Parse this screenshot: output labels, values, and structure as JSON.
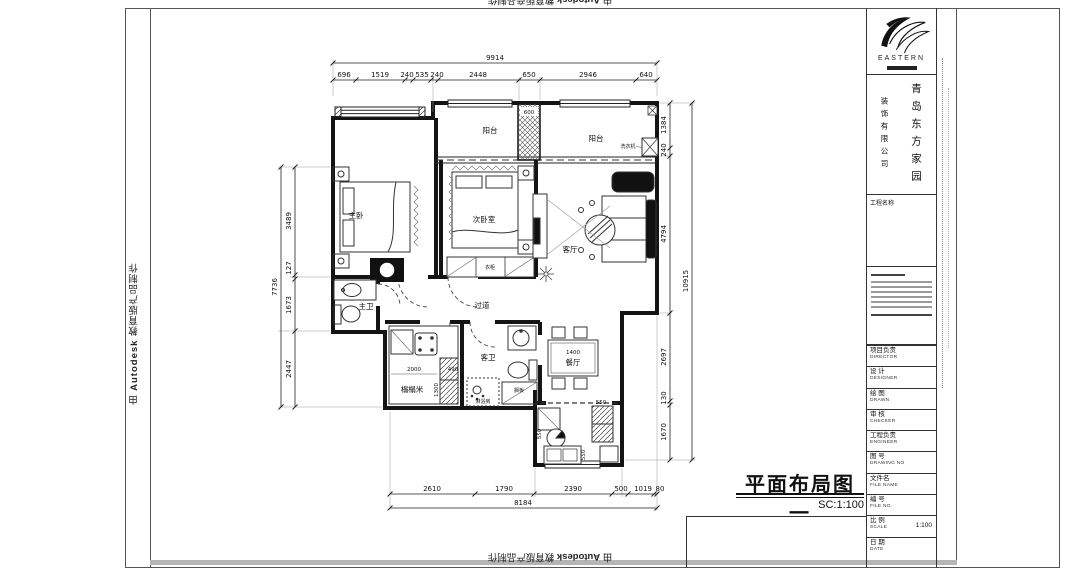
{
  "edge_stamp": {
    "prefix": "由 ",
    "brand": "Autodesk",
    "suffix": " 教育版产品制作"
  },
  "sheet": {
    "title": "平面布局图一",
    "scale_note": "SC:1:100"
  },
  "title_block": {
    "logo_text": "EASTERN",
    "company_name": "青岛东方家园",
    "company_sub": "装饰有限公司",
    "project_name_label": "工程名称",
    "fields": [
      {
        "cn": "项目负责",
        "en": "DIRECTOR",
        "value": ""
      },
      {
        "cn": "设 计",
        "en": "DESIGNER",
        "value": ""
      },
      {
        "cn": "绘 图",
        "en": "DRAWN",
        "value": ""
      },
      {
        "cn": "审 核",
        "en": "CHECKER",
        "value": ""
      },
      {
        "cn": "工程负责",
        "en": "ENGINEER",
        "value": ""
      },
      {
        "cn": "图 号",
        "en": "DRAWING NO",
        "value": ""
      },
      {
        "cn": "文件名",
        "en": "FILE NAME",
        "value": ""
      },
      {
        "cn": "编 号",
        "en": "FILE NO.",
        "value": ""
      },
      {
        "cn": "比 例",
        "en": "SCALE",
        "value": "1:100"
      },
      {
        "cn": "日 期",
        "en": "DATE",
        "value": ""
      }
    ]
  },
  "plan": {
    "rooms": {
      "balcony_left": "阳台",
      "balcony_right": "阳台",
      "master_bedroom": "主卧",
      "second_bedroom": "次卧室",
      "living": "客厅",
      "corridor": "过道",
      "master_bath": "主卫",
      "tatami": "榻榻米",
      "guest_bath": "客卫",
      "dining": "餐厅"
    },
    "fixtures": {
      "washing_machine": "洗衣机",
      "shower": "淋浴房",
      "shelf": "搁板",
      "wardrobe": "衣柜"
    },
    "dims": {
      "top_total": "9914",
      "top": [
        "696",
        "1519",
        "240",
        "535",
        "240",
        "2448",
        "650",
        "2946",
        "640"
      ],
      "left_total": "7736",
      "left": [
        "3489",
        "127",
        "1673",
        "2447"
      ],
      "right_total": "10915",
      "right": [
        "1384",
        "240",
        "4794",
        "2697",
        "130",
        "1670"
      ],
      "bottom_total": "8184",
      "bottom": [
        "2610",
        "1790",
        "2390",
        "500",
        "1019",
        "80"
      ],
      "inner": {
        "balcony_pier": "600",
        "dining_table": "1400",
        "tatami_w": "2000",
        "tatami_gap": "490",
        "tatami_h": "1300",
        "k1": "550",
        "k2": "550",
        "k3": "550"
      }
    }
  }
}
